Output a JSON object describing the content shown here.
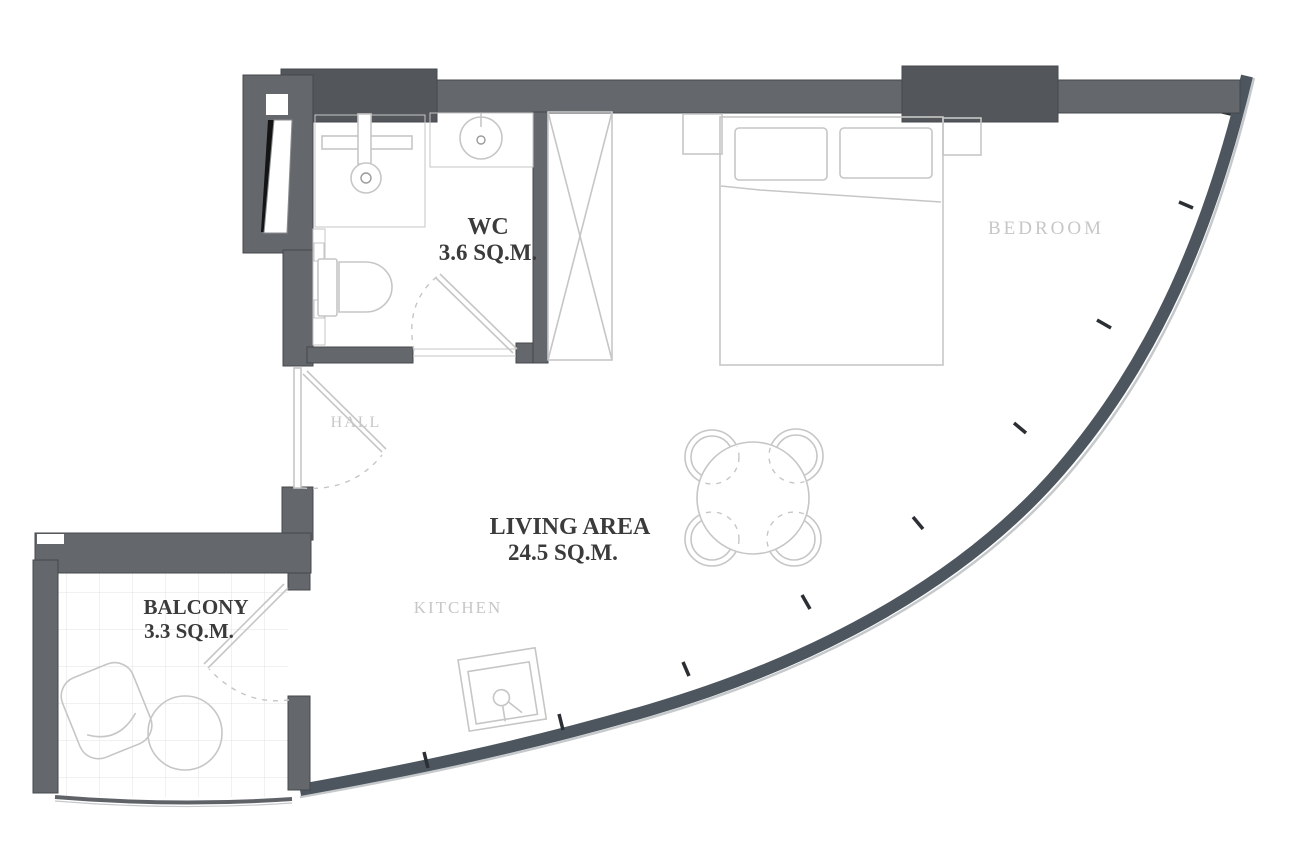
{
  "rooms": {
    "wc": {
      "name": "WC",
      "area": "3.6 SQ.M."
    },
    "bedroom": {
      "name": "BEDROOM"
    },
    "hall": {
      "name": "HALL"
    },
    "living": {
      "name": "LIVING AREA",
      "area": "24.5 SQ.M."
    },
    "kitchen": {
      "name": "KITCHEN"
    },
    "balcony": {
      "name": "BALCONY",
      "area": "3.3 SQ.M."
    }
  },
  "colors": {
    "wall": "#64676c",
    "wall_dark": "#53565b",
    "wall_edge": "#45484d",
    "glass": "#4d565f",
    "glass_outline": "#c6c9cb",
    "rail": "#5f6368",
    "mullion": "#2b2f34",
    "furniture": "#c6c6c6",
    "furniture_dark": "#9a9a9a",
    "label_dark": "#3b3b3b",
    "label_light": "#c7c7c7",
    "tile_grid": "#e3e3e3"
  }
}
